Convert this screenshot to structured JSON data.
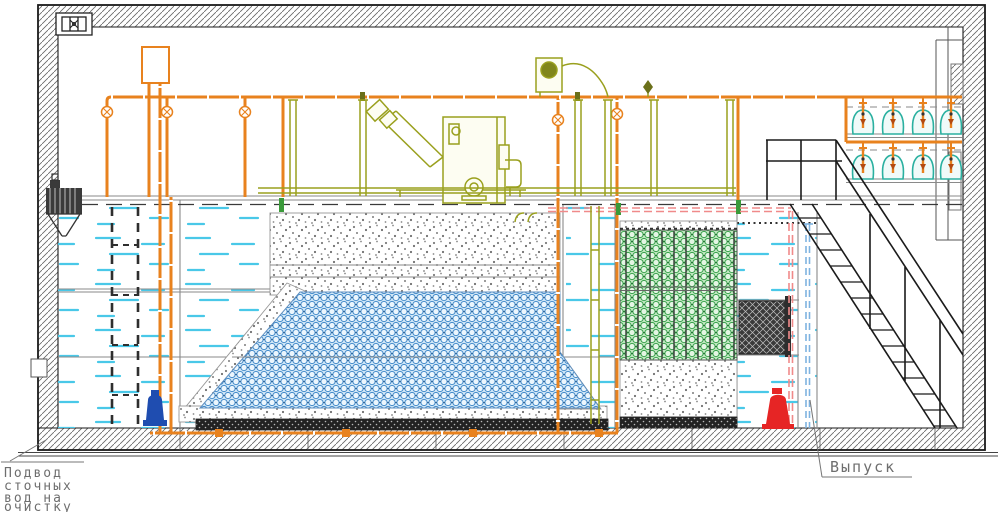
{
  "drawing": {
    "labels": {
      "inlet_line1": "Подвод",
      "inlet_line2": "сточных",
      "inlet_line3": "вод на",
      "inlet_line4": "очистку",
      "outlet": "Выпуск"
    },
    "colors": {
      "pipe_orange": "#E8821E",
      "equipment_olive": "#9AA01E",
      "water_cyan": "#49C8E8",
      "basin_blue": "#3C86C8",
      "media_green": "#2F9E44",
      "sludge_pipe_pink": "#F08A8A",
      "drain_pipe_blue": "#7FB3E0",
      "inlet_pump_blue": "#1F4DB0",
      "outlet_pump_red": "#E62525",
      "diffuser_teal": "#2AB0A0",
      "label_gray": "#6E6E6E"
    }
  }
}
